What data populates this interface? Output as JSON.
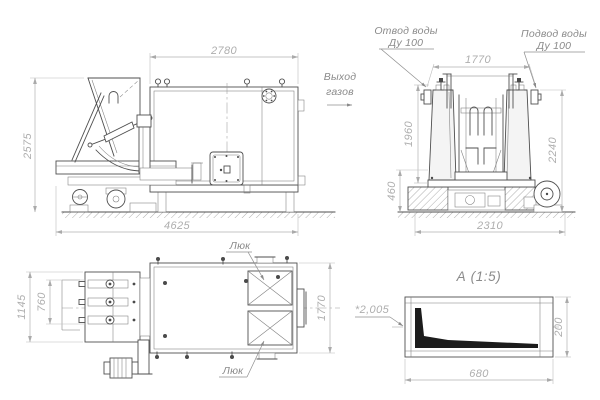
{
  "drawing": {
    "colors": {
      "line": "#4f4f4f",
      "dim_text": "#aeaeae",
      "label_text": "#8a8a8a",
      "detail_fill": "#1c1c1c",
      "background": "#ffffff"
    },
    "side": {
      "width_top": "2780",
      "height_left": "2575",
      "length_bottom": "4625"
    },
    "gas": {
      "line1": "Выход",
      "line2": "газов"
    },
    "front": {
      "width_top": "1770",
      "h_upper": "1960",
      "h_lower": "460",
      "h_right": "2240",
      "w_bottom": "2310",
      "outlet": {
        "l1": "Отвод воды",
        "l2": "Ду 100"
      },
      "inlet": {
        "l1": "Подвод воды",
        "l2": "Ду 100"
      }
    },
    "plan": {
      "h_outer": "1145",
      "h_inner": "760",
      "w_right": "1770",
      "hatch_top": "Люк",
      "hatch_bottom": "Люк"
    },
    "detail": {
      "title": "А (1:5)",
      "width_bottom": "680",
      "height_right": "200",
      "thickness": "*2,005"
    }
  }
}
